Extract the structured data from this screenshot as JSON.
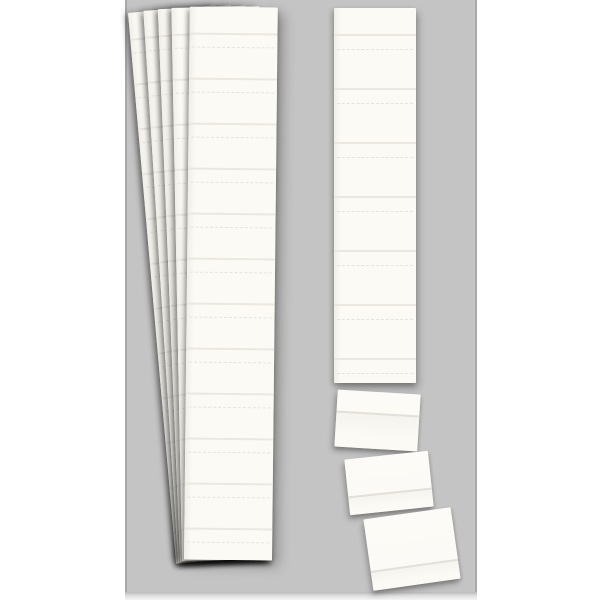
{
  "scene": {
    "description": "Product photo: blank white perforated card strips with detachable insert cards on a grey backdrop, no text",
    "panel": {
      "left": 125,
      "top": 0,
      "width": 352,
      "height": 592
    },
    "floor": {
      "left": 125,
      "top": 592,
      "width": 352,
      "height": 8
    },
    "strip_stack": {
      "top": 7,
      "width": 88,
      "height": 553,
      "strips": [
        {
          "left": 176,
          "angle": -5.0
        },
        {
          "left": 178,
          "angle": -3.6
        },
        {
          "left": 180,
          "angle": -2.3
        },
        {
          "left": 182,
          "angle": -1.1
        },
        {
          "left": 184,
          "angle": 0.6
        }
      ],
      "pattern": {
        "first": 26,
        "unit": 45,
        "count": 12,
        "perf_offset": 14
      }
    },
    "single_strip": {
      "left": 334,
      "top": 8,
      "width": 82,
      "height": 375,
      "angle": 0,
      "pattern": {
        "first": 26,
        "unit": 54,
        "count": 7,
        "perf_offset": 15
      }
    },
    "cards": [
      {
        "left": 336,
        "top": 392,
        "width": 83,
        "height": 57,
        "angle": 3.5,
        "line_pos": 0.36
      },
      {
        "left": 347,
        "top": 455,
        "width": 84,
        "height": 56,
        "angle": -6.0,
        "line_pos": 0.66
      },
      {
        "left": 368,
        "top": 513,
        "width": 88,
        "height": 72,
        "angle": -8.0,
        "line_pos": 0.72
      }
    ]
  },
  "colors": {
    "page_bg": "#ffffff",
    "panel_bg": "#c4c4c4",
    "panel_edge": "#a9a9a9",
    "panel_floor": "#b9b9b9",
    "card": "#fbfaf5",
    "card_edge_shade": "#f0eee7",
    "divider": "#e8e6de",
    "perforation": "#e2e0d8"
  }
}
